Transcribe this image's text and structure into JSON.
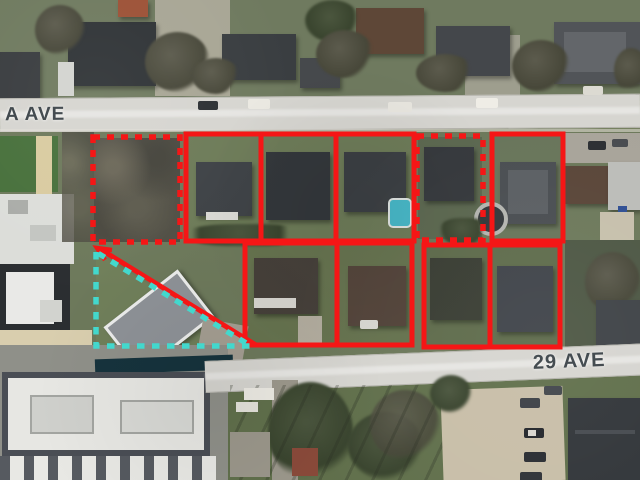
{
  "map": {
    "view": "aerial-satellite-annotated",
    "streets": {
      "top_label": "A AVE",
      "bottom_label": "29 AVE"
    },
    "colors": {
      "outline_red": "#f51616",
      "outline_cyan": "#43d8cd",
      "road_fill": "#d6d5d0",
      "street_text": "#3c4449"
    },
    "annotations": {
      "shapes": [
        {
          "name": "dotted-lot-northwest",
          "kind": "rect",
          "stroke": "outline-red",
          "width": 5.5,
          "dash": "7 7",
          "attrs": {
            "x": 93,
            "y": 137,
            "width": 87,
            "height": 105
          }
        },
        {
          "name": "top-lot-block",
          "kind": "rect",
          "stroke": "outline-red",
          "width": 5,
          "attrs": {
            "x": 186,
            "y": 134,
            "width": 228,
            "height": 107
          }
        },
        {
          "name": "top-lot-divider-1",
          "kind": "line",
          "stroke": "outline-red",
          "width": 5,
          "attrs": {
            "x1": 261,
            "y1": 134,
            "x2": 261,
            "y2": 241
          }
        },
        {
          "name": "top-lot-divider-2",
          "kind": "line",
          "stroke": "outline-red",
          "width": 5,
          "attrs": {
            "x1": 336,
            "y1": 134,
            "x2": 336,
            "y2": 241
          }
        },
        {
          "name": "dotted-lot-top",
          "kind": "rect",
          "stroke": "outline-red",
          "width": 5.5,
          "dash": "7 7",
          "attrs": {
            "x": 417,
            "y": 136,
            "width": 66,
            "height": 104
          }
        },
        {
          "name": "top-lot-east",
          "kind": "rect",
          "stroke": "outline-red",
          "width": 5,
          "attrs": {
            "x": 492,
            "y": 134,
            "width": 71,
            "height": 107
          }
        },
        {
          "name": "bottom-lot-block-west",
          "kind": "rect",
          "stroke": "outline-red",
          "width": 5,
          "attrs": {
            "x": 245,
            "y": 243,
            "width": 167,
            "height": 102
          }
        },
        {
          "name": "bottom-lot-divider-1",
          "kind": "line",
          "stroke": "outline-red",
          "width": 5,
          "attrs": {
            "x1": 337,
            "y1": 243,
            "x2": 337,
            "y2": 345
          }
        },
        {
          "name": "bottom-lot-block-east",
          "kind": "rect",
          "stroke": "outline-red",
          "width": 5,
          "attrs": {
            "x": 424,
            "y": 245,
            "width": 136,
            "height": 102
          }
        },
        {
          "name": "bottom-lot-divider-2",
          "kind": "line",
          "stroke": "outline-red",
          "width": 5,
          "attrs": {
            "x1": 490,
            "y1": 245,
            "x2": 490,
            "y2": 347
          }
        },
        {
          "name": "red-arrow-shaft",
          "kind": "line",
          "stroke": "outline-red",
          "width": 5,
          "attrs": {
            "x1": 256,
            "y1": 345,
            "x2": 100,
            "y2": 249
          }
        },
        {
          "name": "red-arrow-head",
          "kind": "polyline",
          "stroke": "outline-red",
          "width": 4.5,
          "attrs": {
            "points": "112,250 97,248 105,260"
          }
        },
        {
          "name": "cyan-dashed-parcel",
          "kind": "path",
          "stroke": "outline-cyan",
          "width": 5.5,
          "dash": "7.5 7.5",
          "attrs": {
            "d": "M 96 252 L 96 346 L 251 346 Z"
          }
        }
      ]
    }
  }
}
